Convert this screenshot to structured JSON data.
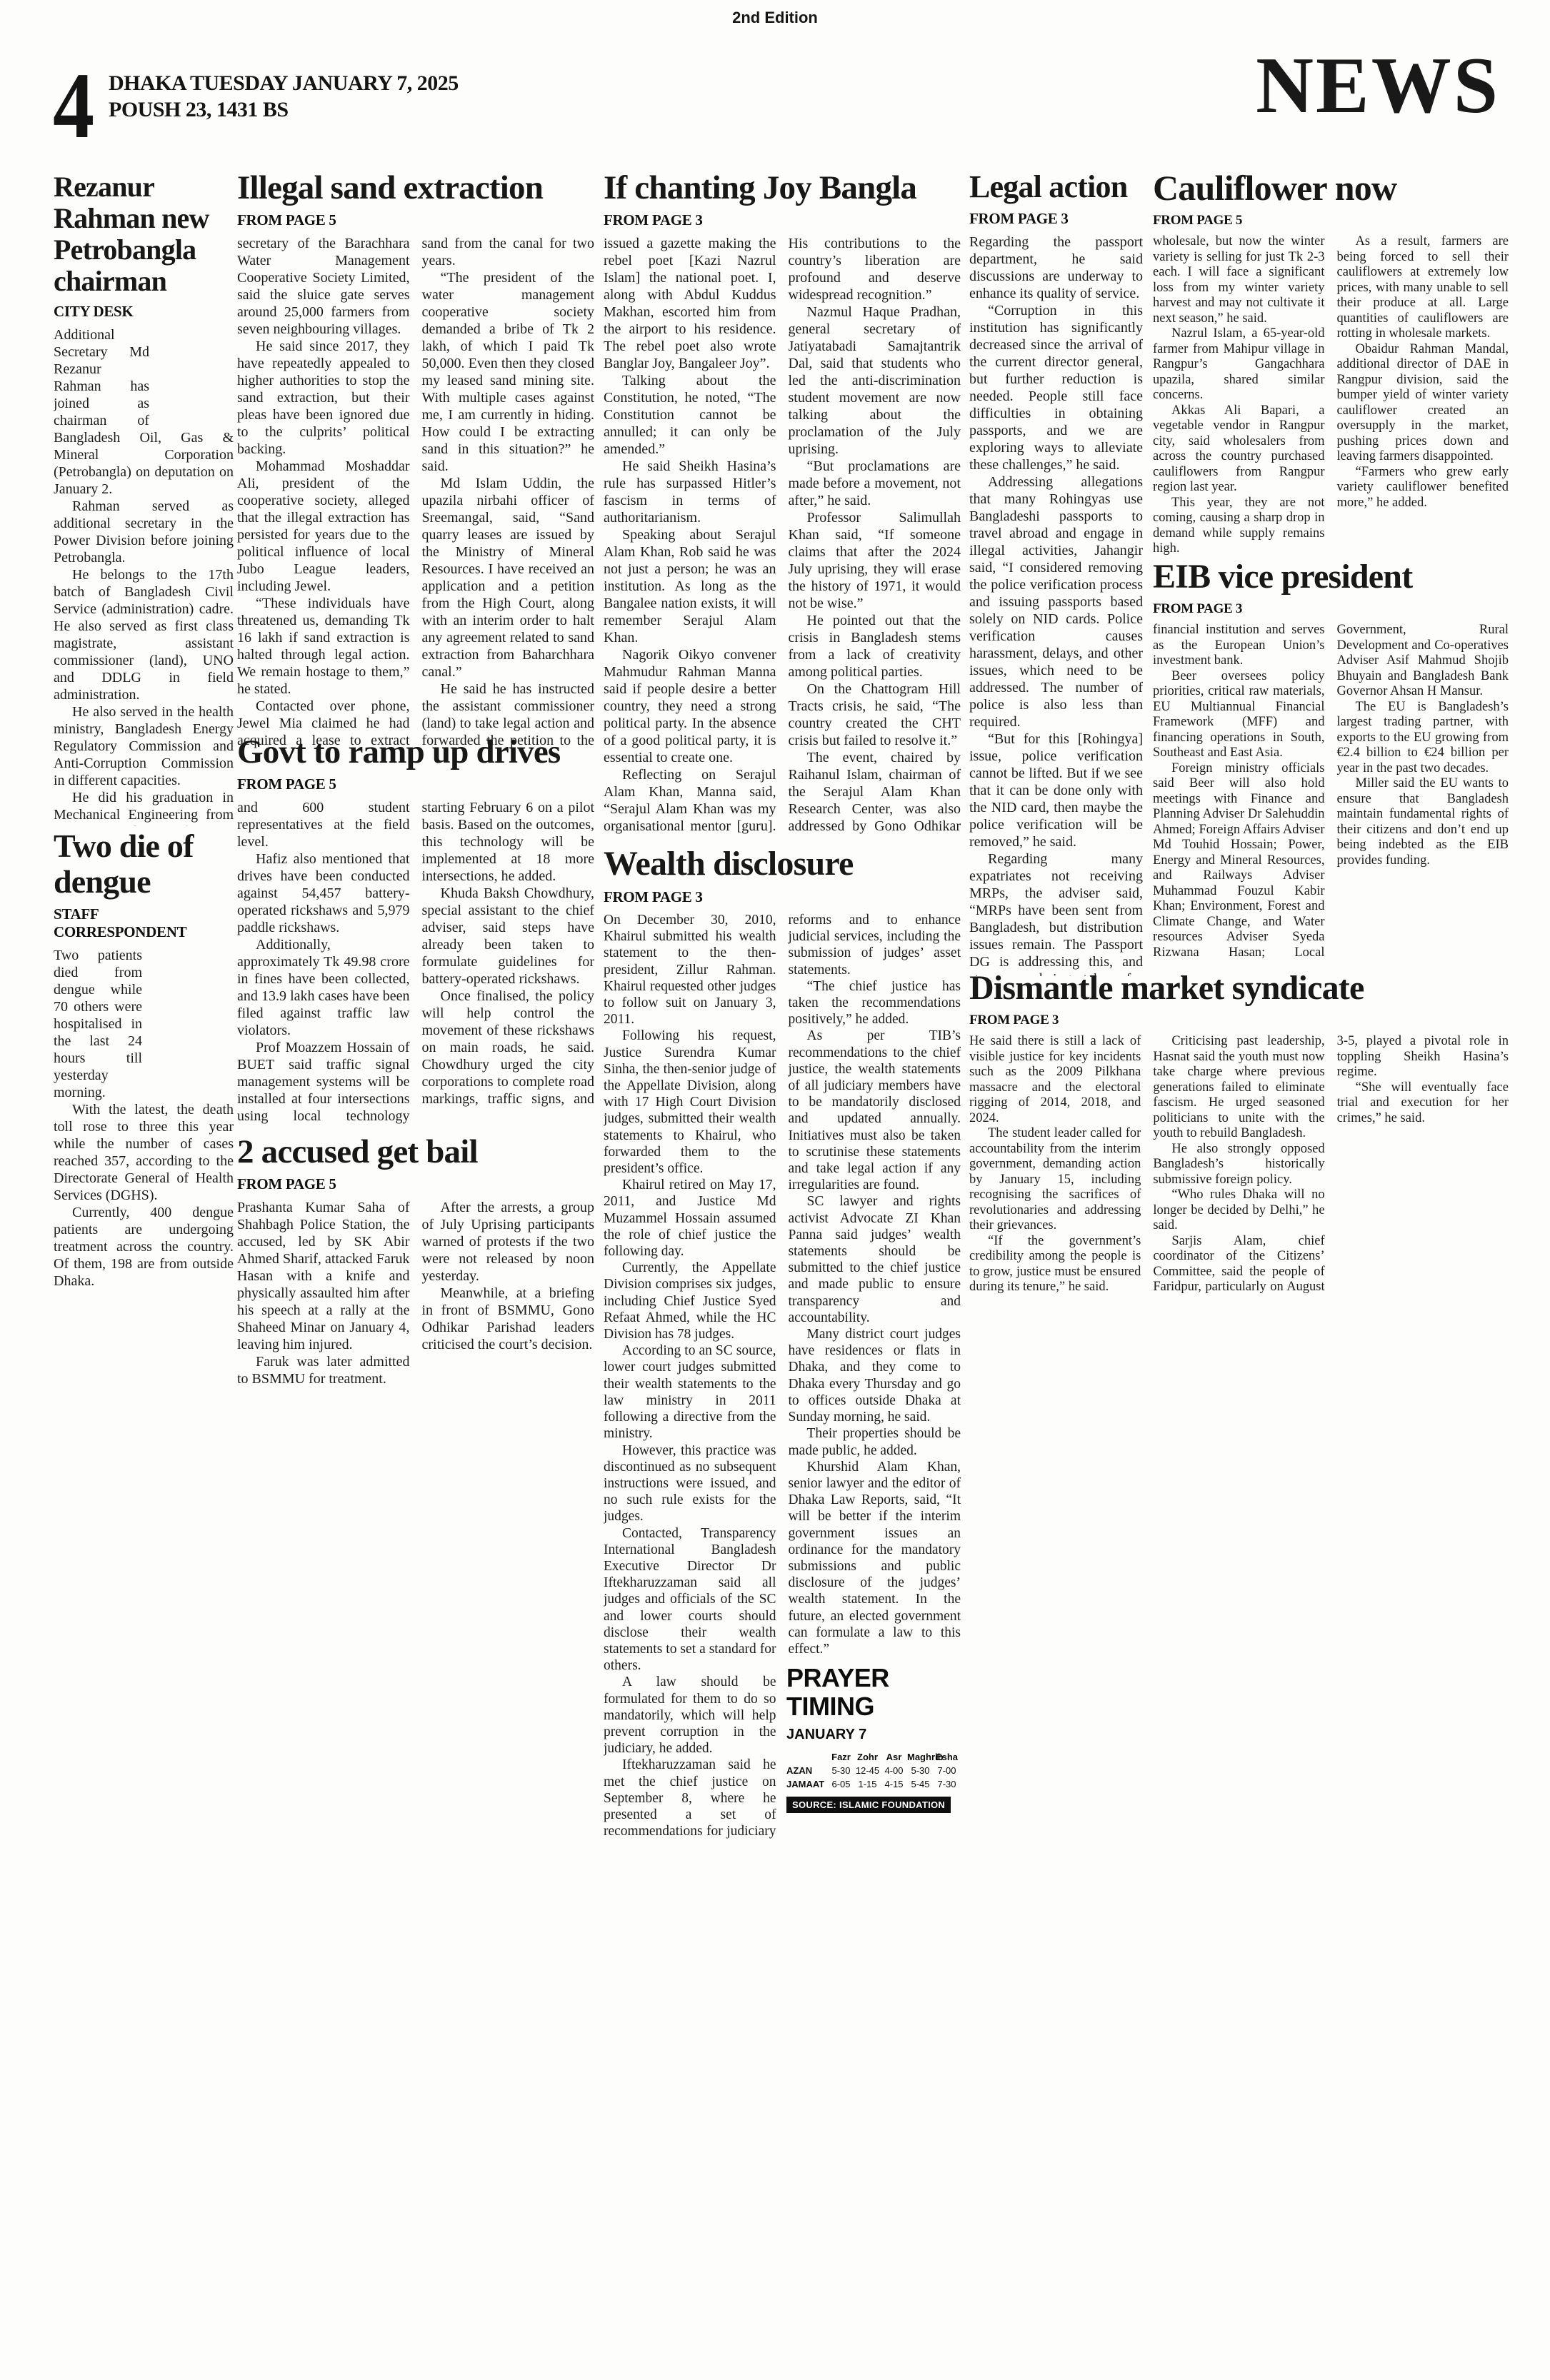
{
  "edition": "2nd Edition",
  "masthead": {
    "page_number": "4",
    "dateline": "DHAKA TUESDAY JANUARY 7, 2025",
    "calendar": "POUSH 23, 1431 BS",
    "section": "NEWS"
  },
  "articles": {
    "rezanur": {
      "headline": "Rezanur Rahman new Petrobangla chairman",
      "kicker": "CITY DESK",
      "paragraphs": [
        "Additional Secretary Md Rezanur Rahman has joined as chairman of Bangladesh Oil, Gas & Mineral Corporation (Petrobangla) on deputation on January 2.",
        "Rahman served as additional secretary in the Power Division before joining Petrobangla.",
        "He belongs to the 17th batch of Bangladesh Civil Service (administration) cadre. He also served as first class magistrate, assistant commissioner (land), UNO and DDLG in field administration.",
        "He also served in the health ministry, Bangladesh Energy Regulatory Commission and Anti-Corruption Commission in different capacities.",
        "He did his graduation in Mechanical Engineering from BUET and Professional Master’s degree in ITC, Netherlands."
      ]
    },
    "dengue": {
      "headline": "Two die of dengue",
      "kicker": "STAFF CORRESPONDENT",
      "paragraphs": [
        "Two patients died from dengue while 70 others were hospitalised in the last 24 hours till yesterday morning.",
        "With the latest, the death toll rose to three this year while the number of cases reached 357, according to the Directorate General of Health Services (DGHS).",
        "Currently, 400 dengue patients are undergoing treatment across the country. Of them, 198 are from outside Dhaka."
      ]
    },
    "illegal_sand": {
      "headline": "Illegal sand extraction",
      "kicker": "FROM PAGE 5",
      "paragraphs": [
        "secretary of the Barachhara Water Management Cooperative Society Limited, said the sluice gate serves around 25,000 farmers from seven neighbouring villages.",
        "He said since 2017, they have repeatedly appealed to higher authorities to stop the sand extraction, but their pleas have been ignored due to the culprits’ political backing.",
        "Mohammad Moshaddar Ali, president of the cooperative society, alleged that the illegal extraction has persisted for years due to the political influence of local Jubo League leaders, including Jewel.",
        "“These individuals have threatened us, demanding Tk 16 lakh if sand extraction is halted through legal action. We remain hostage to them,” he stated.",
        "Contacted over phone, Jewel Mia claimed he had acquired a lease to extract sand from the canal for two years.",
        "“The president of the water management cooperative society demanded a bribe of Tk 2 lakh, of which I paid Tk 50,000. Even then they closed my leased sand mining site. With multiple cases against me, I am currently in hiding. How could I be extracting sand in this situation?” he said.",
        "Md Islam Uddin, the upazila nirbahi officer of Sreemangal, said, “Sand quarry leases are issued by the Ministry of Mineral Resources. I have received an application and a petition from the High Court, along with an interim order to halt any agreement related to sand extraction from Baharchhara canal.”",
        "He said he has instructed the assistant commissioner (land) to take legal action and forwarded the petition to the Ministry of Mineral Resources for further review."
      ]
    },
    "govt_drives": {
      "headline": "Govt to ramp up drives",
      "kicker": "FROM PAGE 5",
      "paragraphs": [
        "and 600 student representatives at the field level.",
        "Hafiz also mentioned that drives have been conducted against 54,457 battery-operated rickshaws and 5,979 paddle rickshaws.",
        "Additionally, approximately Tk 49.98 crore in fines have been collected, and 13.9 lakh cases have been filed against traffic law violators.",
        "Prof Moazzem Hossain of BUET said traffic signal management systems will be installed at four intersections using local technology starting February 6 on a pilot basis. Based on the outcomes, this technology will be implemented at 18 more intersections, he added.",
        "Khuda Baksh Chowdhury, special assistant to the chief adviser, said steps have already been taken to formulate guidelines for battery-operated rickshaws.",
        "Once finalised, the policy will help control the movement of these rickshaws on main roads, he said. Chowdhury urged the city corporations to complete road markings, traffic signs, and proper bus stop markings to improve traffic movement."
      ]
    },
    "accused_bail": {
      "headline": "2 accused get bail",
      "kicker": "FROM PAGE 5",
      "paragraphs": [
        "Prashanta Kumar Saha of Shahbagh Police Station, the accused, led by SK Abir Ahmed Sharif, attacked Faruk Hasan with a knife and physically assaulted him after his speech at a rally at the Shaheed Minar on January 4, leaving him injured.",
        "Faruk was later admitted to BSMMU for treatment.",
        "After the arrests, a group of July Uprising participants warned of protests if the two were not released by noon yesterday.",
        "Meanwhile, at a briefing in front of BSMMU, Gono Odhikar Parishad leaders criticised the court’s decision."
      ]
    },
    "joy_bangla": {
      "headline": "If chanting Joy Bangla",
      "kicker": "FROM PAGE 3",
      "paragraphs": [
        "issued a gazette making the rebel poet [Kazi Nazrul Islam] the national poet. I, along with Abdul Kuddus Makhan, escorted him from the airport to his residence. The rebel poet also wrote Banglar Joy, Bangaleer Joy”.",
        "Talking about the Constitution, he noted, “The Constitution cannot be annulled; it can only be amended.”",
        "He said Sheikh Hasina’s rule has surpassed Hitler’s fascism in terms of authoritarianism.",
        "Speaking about Serajul Alam Khan, Rob said he was not just a person; he was an institution. As long as the Bangalee nation exists, it will remember Serajul Alam Khan.",
        "Nagorik Oikyo convener Mahmudur Rahman Manna said if people desire a better country, they need a strong political party. In the absence of a good political party, it is essential to create one.",
        "Reflecting on Serajul Alam Khan, Manna said, “Serajul Alam Khan was my organisational mentor [guru]. His contributions to the country’s liberation are profound and deserve widespread recognition.”",
        "Nazmul Haque Pradhan, general secretary of Jatiyatabadi Samajtantrik Dal, said that students who led the anti-discrimination student movement are now talking about the proclamation of the July uprising.",
        "“But proclamations are made before a movement, not after,” he said.",
        "Professor Salimullah Khan said, “If someone claims that after the 2024 July uprising, they will erase the history of 1971, it would not be wise.”",
        "He pointed out that the crisis in Bangladesh stems from a lack of creativity among political parties.",
        "On the Chattogram Hill Tracts crisis, he said, “The country created the CHT crisis but failed to resolve it.”",
        "The event, chaired by Raihanul Islam, chairman of the Serajul Alam Khan Research Center, was also addressed by Gono Odhikar Parishad’s General Secretary Rashed Khan, freedom fighters Mozzammel Haque Bir Pratik, and Anowar Hossain."
      ]
    },
    "wealth": {
      "headline": "Wealth disclosure",
      "kicker": "FROM PAGE 3",
      "paragraphs": [
        "On December 30, 2010, Khairul submitted his wealth statement to the then-president, Zillur Rahman. Khairul requested other judges to follow suit on January 3, 2011.",
        "Following his request, Justice Surendra Kumar Sinha, the then-senior judge of the Appellate Division, along with 17 High Court Division judges, submitted their wealth statements to Khairul, who forwarded them to the president’s office.",
        "Khairul retired on May 17, 2011, and Justice Md Muzammel Hossain assumed the role of chief justice the following day.",
        "Currently, the Appellate Division comprises six judges, including Chief Justice Syed Refaat Ahmed, while the HC Division has 78 judges.",
        "According to an SC source, lower court judges submitted their wealth statements to the law ministry in 2011 following a directive from the ministry.",
        "However, this practice was discontinued as no subsequent instructions were issued, and no such rule exists for the judges.",
        "Contacted, Transparency International Bangladesh Executive Director Dr Iftekharuzzaman said all judges and officials of the SC and lower courts should disclose their wealth statements to set a standard for others.",
        "A law should be formulated for them to do so mandatorily, which will help prevent corruption in the judiciary, he added.",
        "Iftekharuzzaman said he met the chief justice on September 8, where he presented a set of recommendations for judiciary reforms and to enhance judicial services, including the submission of judges’ asset statements.",
        "“The chief justice has taken the recommendations positively,” he added.",
        "As per TIB’s recommendations to the chief justice, the wealth statements of all judiciary members have to be mandatorily disclosed and updated annually. Initiatives must also be taken to scrutinise these statements and take legal action if any irregularities are found.",
        "SC lawyer and rights activist Advocate ZI Khan Panna said judges’ wealth statements should be submitted to the chief justice and made public to ensure transparency and accountability.",
        "Many district court judges have residences or flats in Dhaka, and they come to Dhaka every Thursday and go to offices outside Dhaka at Sunday morning, he said.",
        "Their properties should be made public, he added.",
        "Khurshid Alam Khan, senior lawyer and the editor of Dhaka Law Reports, said, “It will be better if the interim government issues an ordinance for the mandatory submissions and public disclosure of the judges’ wealth statement. In the future, an elected government can formulate a law to this effect.”"
      ]
    },
    "legal_action": {
      "headline": "Legal action",
      "kicker": "FROM PAGE 3",
      "paragraphs": [
        "Regarding the passport department, he said discussions are underway to enhance its quality of service.",
        "“Corruption in this institution has significantly decreased since the arrival of the current director general, but further reduction is needed. People still face difficulties in obtaining passports, and we are exploring ways to alleviate these challenges,” he said.",
        "Addressing allegations that many Rohingyas use Bangladeshi passports to travel abroad and engage in illegal activities, Jahangir said, “I considered removing the police verification process and issuing passports based solely on NID cards. Police verification causes harassment, delays, and other issues, which need to be addressed. The number of police is also less than required.",
        "“But for this [Rohingya] issue, police verification cannot be lifted. But if we see that it can be done only with the NID card, then maybe the police verification will be removed,” he said.",
        "Regarding many expatriates not receiving MRPs, the adviser said, “MRPs have been sent from Bangladesh, but distribution issues remain. The Passport DG is addressing this, and steps are being taken for faster delivery.”"
      ]
    },
    "cauliflower": {
      "headline": "Cauliflower now",
      "kicker": "FROM PAGE 5",
      "paragraphs": [
        "wholesale, but now the winter variety is selling for just Tk 2-3 each. I will face a significant loss from my winter variety harvest and may not cultivate it next season,” he said.",
        "Nazrul Islam, a 65-year-old farmer from Mahipur village in Rangpur’s Gangachhara upazila, shared similar concerns.",
        "Akkas Ali Bapari, a vegetable vendor in Rangpur city, said wholesalers from across the country purchased cauliflowers from Rangpur region last year.",
        "This year, they are not coming, causing a sharp drop in demand while supply remains high.",
        "As a result, farmers are being forced to sell their cauliflowers at extremely low prices, with many unable to sell their produce at all. Large quantities of cauliflowers are rotting in wholesale markets.",
        "Obaidur Rahman Mandal, additional director of DAE in Rangpur division, said the bumper yield of winter variety cauliflower created an oversupply in the market, pushing prices down and leaving farmers disappointed.",
        "“Farmers who grew early variety cauliflower benefited more,” he added."
      ]
    },
    "eib": {
      "headline": "EIB vice president",
      "kicker": "FROM PAGE 3",
      "paragraphs": [
        "financial institution and serves as the European Union’s investment bank.",
        "Beer oversees policy priorities, critical raw materials, EU Multiannual Financial Framework (MFF) and financing operations in South, Southeast and East Asia.",
        "Foreign ministry officials said Beer will also hold meetings with Finance and Planning Adviser Dr Salehuddin Ahmed; Foreign Affairs Adviser Md Touhid Hossain; Power, Energy and Mineral Resources, and Railways Adviser Muhammad Fouzul Kabir Khan; Environment, Forest and Climate Change, and Water resources Adviser Syeda Rizwana Hasan; Local Government, Rural Development and Co-operatives Adviser Asif Mahmud Shojib Bhuyain and Bangladesh Bank Governor Ahsan H Mansur.",
        "The EU is Bangladesh’s largest trading partner, with exports to the EU growing from €2.4 billion to €24 billion per year in the past two decades.",
        "Miller said the EU wants to ensure that Bangladesh maintain fundamental rights of their citizens and don’t end up being indebted as the EIB provides funding."
      ]
    },
    "dismantle": {
      "headline": "Dismantle market syndicate",
      "kicker": "FROM PAGE 3",
      "paragraphs": [
        "He said there is still a lack of visible justice for key incidents such as the 2009 Pilkhana massacre and the electoral rigging of 2014, 2018, and 2024.",
        "The student leader called for accountability from the interim government, demanding action by January 15, including recognising the sacrifices of revolutionaries and addressing their grievances.",
        "“If the government’s credibility among the people is to grow, justice must be ensured during its tenure,” he said.",
        "Criticising past leadership, Hasnat said the youth must now take charge where previous generations failed to eliminate fascism. He urged seasoned politicians to unite with the youth to rebuild Bangladesh.",
        "He also strongly opposed Bangladesh’s historically submissive foreign policy.",
        "“Who rules Dhaka will no longer be decided by Delhi,” he said.",
        "Sarjis Alam, chief coordinator of the Citizens’ Committee, said the people of Faridpur, particularly on August 3-5, played a pivotal role in toppling Sheikh Hasina’s regime.",
        "“She will eventually face trial and execution for her crimes,” he said."
      ]
    }
  },
  "prayer": {
    "title": "PRAYER TIMING",
    "date": "JANUARY 7",
    "columns": [
      "Fazr",
      "Zohr",
      "Asr",
      "Maghrib",
      "Esha"
    ],
    "rows": [
      {
        "label": "AZAN",
        "times": [
          "5-30",
          "12-45",
          "4-00",
          "5-30",
          "7-00"
        ]
      },
      {
        "label": "JAMAAT",
        "times": [
          "6-05",
          "1-15",
          "4-15",
          "5-45",
          "7-30"
        ]
      }
    ],
    "source": "SOURCE: ISLAMIC FOUNDATION"
  }
}
